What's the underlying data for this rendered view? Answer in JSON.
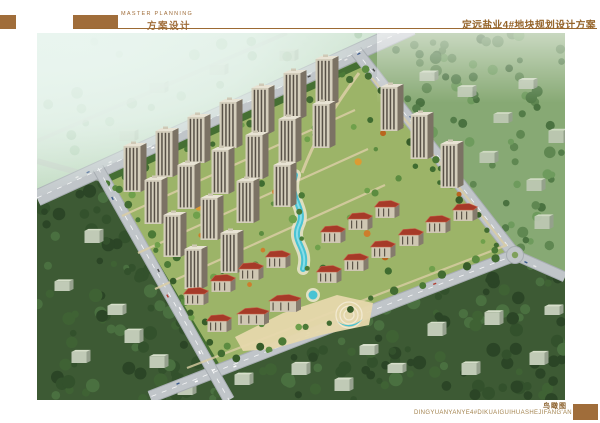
{
  "header": {
    "eyebrow": "MASTER PLANNING",
    "subtitle": "方案设计",
    "title": "定远盐业4#地块规划设计方案"
  },
  "footer": {
    "caption": "鸟瞰图",
    "caption_pinyin": "DINGYUANYANYE4#DIKUAIGUIHUASHEJIFANG'AN"
  },
  "colors": {
    "accent_brown": "#a06d3a",
    "rule_brown": "#9c6a33",
    "title_brown": "#95642a",
    "caption_brown": "#8a5f2a",
    "pinyin_tan": "#a3834e",
    "scene": {
      "bg_green": "#8fa877",
      "fog_light": "#e9f5ef",
      "fog_green": "#aacba6",
      "context_green": "#87a974",
      "forest_dark": "#3d5a34",
      "site_green": "#9cb468",
      "site_edge_green": "#456f33",
      "road_gray": "#c0c5c9",
      "road_edge": "#a7adb2",
      "marking_white": "#ffffff",
      "pool_cyan": "#49c3d3",
      "pool_light": "#8fe0ea",
      "deck_white": "#efe9d4",
      "roof_red": "#a63a28",
      "roof_red_hi": "#c9604a",
      "tower_wall": "#d4cebc",
      "tower_side": "#7b7264",
      "tower_roof": "#e8e3d4",
      "window_dark": "#575046",
      "path_beige": "#d9cda4",
      "plaza_beige": "#e6d8ac",
      "slab_wall": "#c0cab6",
      "slab_side": "#96a18e",
      "slab_roof": "#d7dfcb",
      "tree_orange": "#cd7e2c"
    }
  }
}
